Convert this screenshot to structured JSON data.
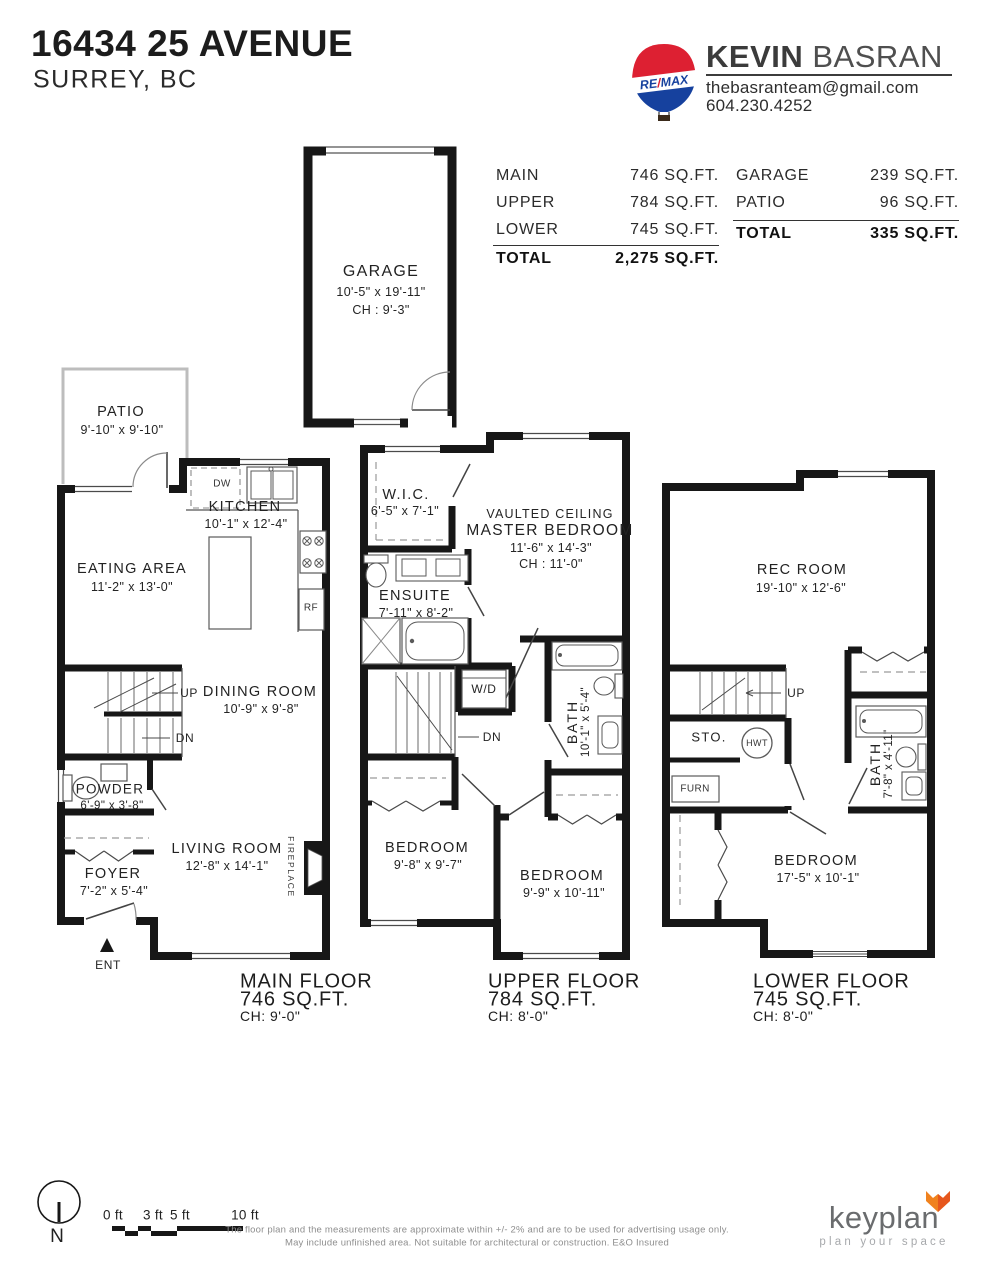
{
  "header": {
    "address": "16434 25 AVENUE",
    "city": "SURREY, BC",
    "agent": {
      "first_name": "KEVIN",
      "last_name": "BASRAN",
      "email": "thebasranteam@gmail.com",
      "phone": "604.230.4252",
      "brand_re": "RE",
      "brand_slash": "/",
      "brand_max": "MAX"
    }
  },
  "area_summary": {
    "left": {
      "rows": [
        {
          "label": "MAIN",
          "value": "746 SQ.FT."
        },
        {
          "label": "UPPER",
          "value": "784 SQ.FT."
        },
        {
          "label": "LOWER",
          "value": "745 SQ.FT."
        }
      ],
      "total_label": "TOTAL",
      "total_value": "2,275 SQ.FT."
    },
    "right": {
      "rows": [
        {
          "label": "GARAGE",
          "value": "239 SQ.FT."
        },
        {
          "label": "PATIO",
          "value": "96 SQ.FT."
        }
      ],
      "total_label": "TOTAL",
      "total_value": "335 SQ.FT."
    }
  },
  "garage": {
    "name": "GARAGE",
    "dims": "10'-5\" x 19'-11\"",
    "ch": "CH : 9'-3\""
  },
  "main_floor": {
    "patio": {
      "name": "PATIO",
      "dims": "9'-10\" x 9'-10\""
    },
    "kitchen": {
      "name": "KITCHEN",
      "dims": "10'-1\" x 12'-4\""
    },
    "eating_area": {
      "name": "EATING AREA",
      "dims": "11'-2\" x 13'-0\""
    },
    "dining_room": {
      "name": "DINING ROOM",
      "dims": "10'-9\" x 9'-8\""
    },
    "powder": {
      "name": "POWDER",
      "dims": "6'-9\" x 3'-8\""
    },
    "foyer": {
      "name": "FOYER",
      "dims": "7'-2\" x 5'-4\""
    },
    "living_room": {
      "name": "LIVING ROOM",
      "dims": "12'-8\" x 14'-1\""
    },
    "up": "UP",
    "dn": "DN",
    "dw": "DW",
    "rf": "RF",
    "fireplace": "FIREPLACE",
    "ent": "ENT",
    "title": "MAIN FLOOR",
    "area": "746 SQ.FT.",
    "ch": "CH: 9'-0\""
  },
  "upper_floor": {
    "wic": {
      "name": "W.I.C.",
      "dims": "6'-5\" x 7'-1\""
    },
    "master": {
      "note": "VAULTED CEILING",
      "name": "MASTER BEDROOM",
      "dims": "11'-6\" x 14'-3\"",
      "ch": "CH : 11'-0\""
    },
    "ensuite": {
      "name": "ENSUITE",
      "dims": "7'-11\" x 8'-2\""
    },
    "bath": {
      "name": "BATH",
      "dims": "10'-1\" x 5'-4\""
    },
    "bedroom_left": {
      "name": "BEDROOM",
      "dims": "9'-8\" x 9'-7\""
    },
    "bedroom_right": {
      "name": "BEDROOM",
      "dims": "9'-9\" x 10'-11\""
    },
    "wd": "W/D",
    "dn": "DN",
    "title": "UPPER FLOOR",
    "area": "784 SQ.FT.",
    "ch": "CH: 8'-0\""
  },
  "lower_floor": {
    "rec_room": {
      "name": "REC ROOM",
      "dims": "19'-10\" x 12'-6\""
    },
    "storage": {
      "name": "STO."
    },
    "bath": {
      "name": "BATH",
      "dims": "7'-8\" x 4'-11\""
    },
    "bedroom": {
      "name": "BEDROOM",
      "dims": "17'-5\" x 10'-1\""
    },
    "up": "UP",
    "hwt": "HWT",
    "furn": "FURN",
    "title": "LOWER FLOOR",
    "area": "745 SQ.FT.",
    "ch": "CH: 8'-0\""
  },
  "footer": {
    "compass": "N",
    "scale_ticks": [
      "0 ft",
      "3 ft",
      "5 ft",
      "10 ft"
    ],
    "disclaimer_line1": "The floor plan and the measurements are approximate within +/- 2% and are to be used for advertising usage only.",
    "disclaimer_line2": "May include unfinished area. Not suitable for architectural or construction. E&O Insured",
    "brand": {
      "name": "keyplan",
      "tagline": "plan your space"
    }
  }
}
